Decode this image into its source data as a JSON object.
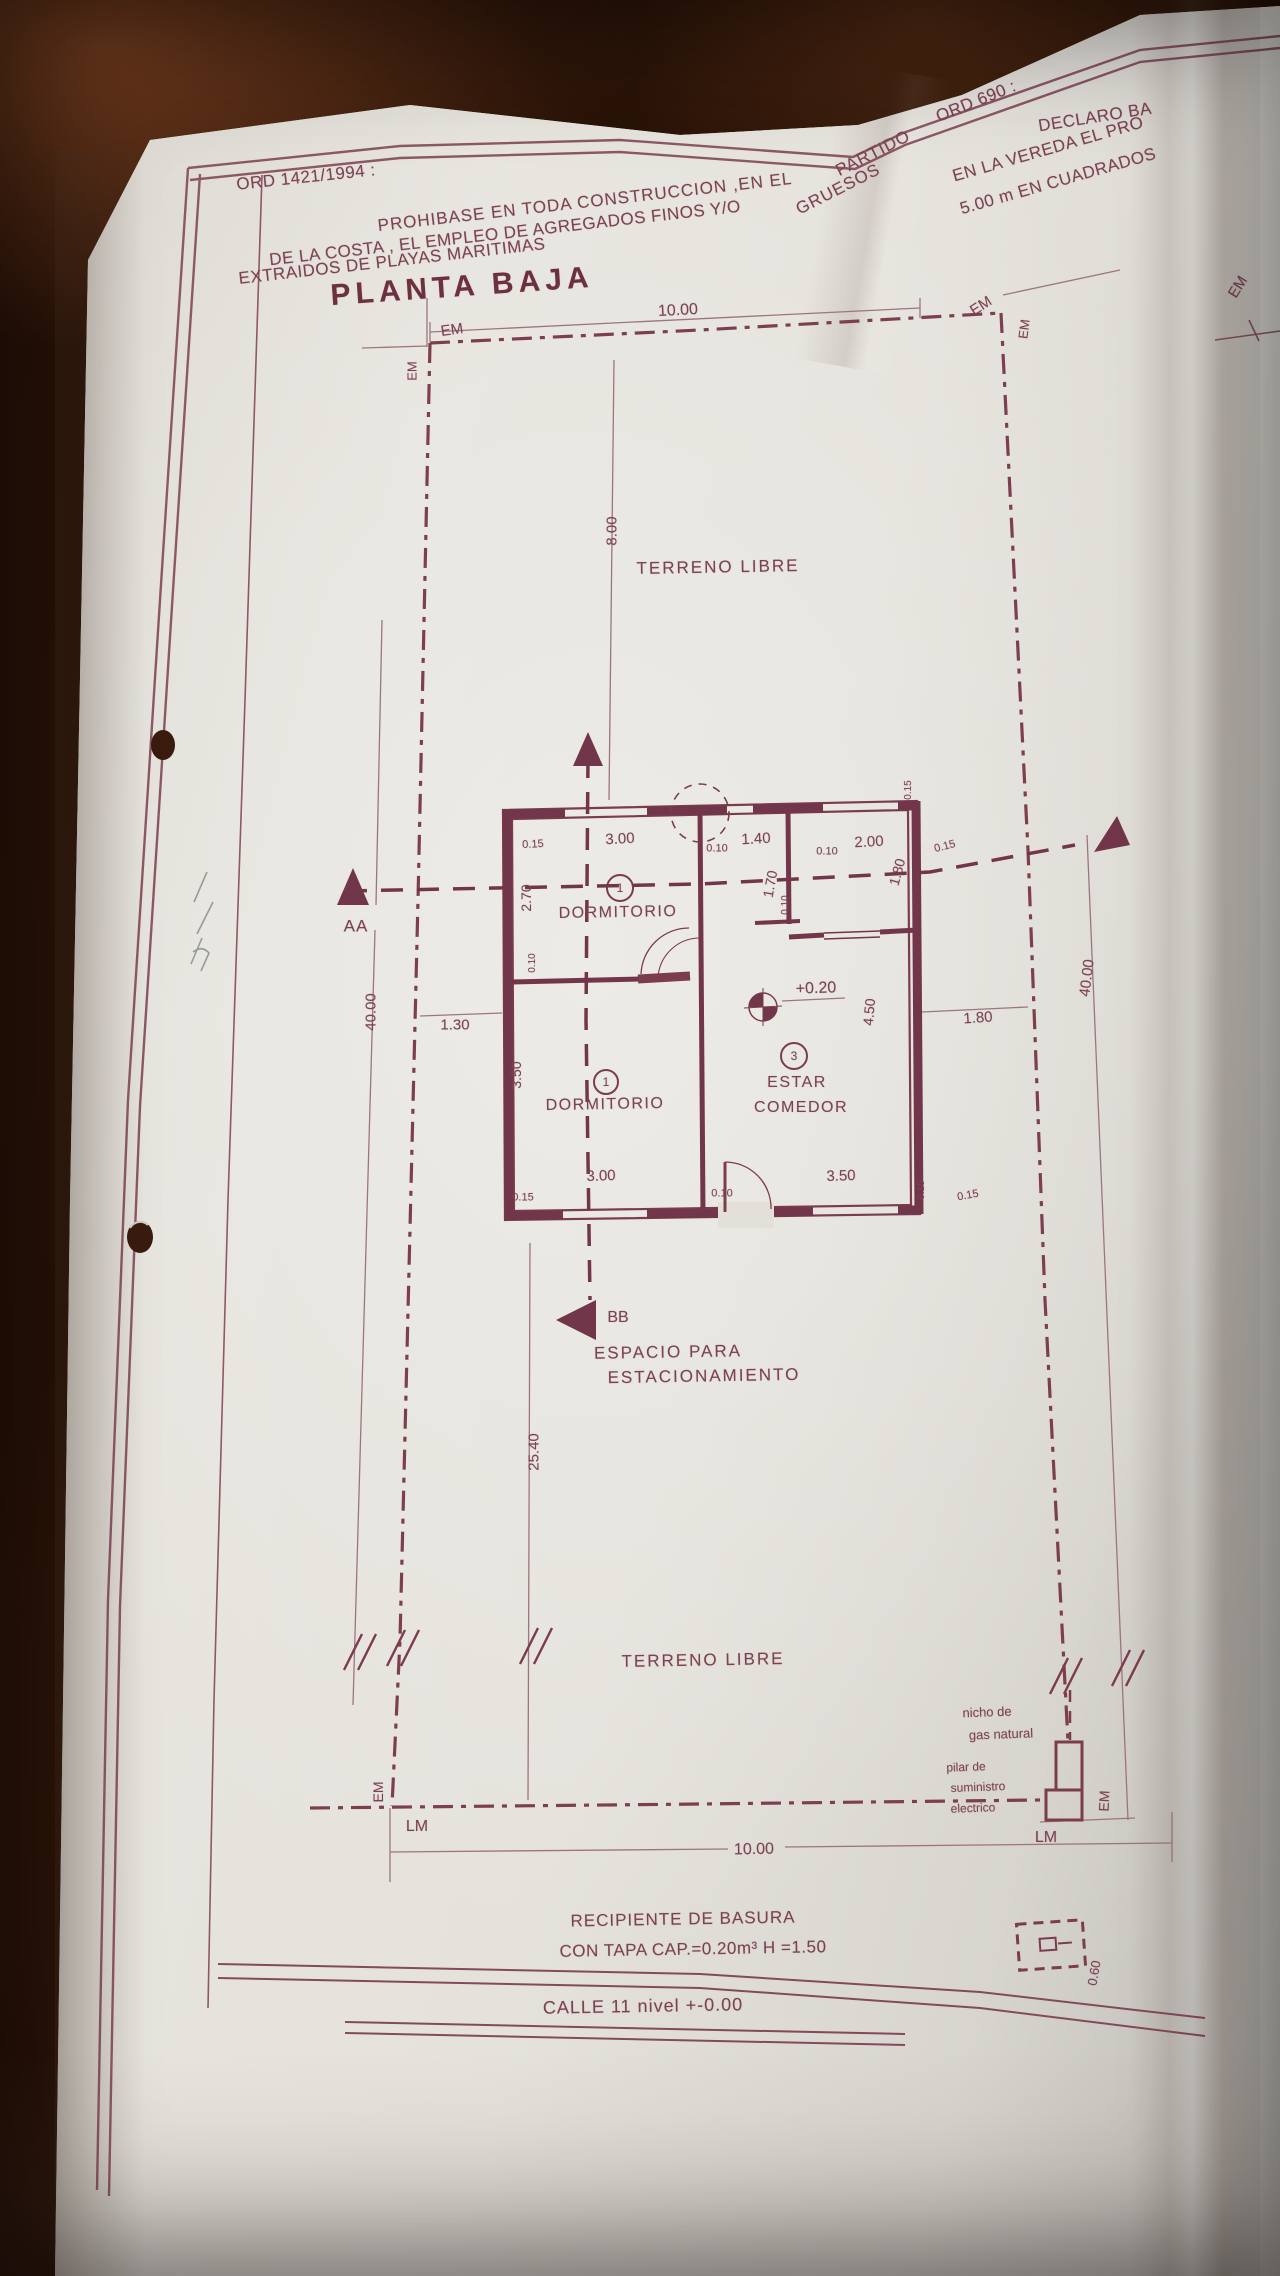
{
  "colors": {
    "ink": "#7c4253",
    "ink_dark": "#6d3040",
    "ink_light": "#9d7580",
    "paper": "#e7e4de",
    "table_wood": "#2c1207"
  },
  "title": "PLANTA BAJA",
  "ordinance_1421": {
    "ref": "ORD 1421/1994 :",
    "text": "PROHIBASE EN TODA CONSTRUCCION ,EN EL PARTIDO DE LA COSTA , EL EMPLEO DE AGREGADOS FINOS Y/O GRUESOS EXTRAIDOS DE PLAYAS MARITIMAS"
  },
  "ordinance_690": {
    "ref": "ORD 690 :",
    "text": "DECLARO BA EN LA VEREDA EL PRO 5.00 m EN CUADRADOS"
  },
  "street": "CALLE 11 nivel +-0.00",
  "labels": [
    {
      "n": "ord-1421-ref",
      "t": "ORD 1421/1994 :",
      "x": 306,
      "y": 177,
      "s": 17,
      "r": -6,
      "ls": 0.5
    },
    {
      "n": "ord-1421-line-1",
      "t": "PROHIBASE EN TODA CONSTRUCCION ,EN EL",
      "x": 585,
      "y": 202,
      "s": 17,
      "r": -6.5,
      "ls": 1
    },
    {
      "n": "ord-1421-partido",
      "t": "PARTIDO",
      "x": 873,
      "y": 153,
      "s": 17,
      "r": -27,
      "ls": 1
    },
    {
      "n": "ord-1421-line-2",
      "t": "DE LA COSTA , EL EMPLEO DE AGREGADOS FINOS Y/O",
      "x": 505,
      "y": 233,
      "s": 17,
      "r": -6.5,
      "ls": 0.5
    },
    {
      "n": "ord-1421-gruesos",
      "t": "GRUESOS",
      "x": 838,
      "y": 189,
      "s": 17,
      "r": -27,
      "ls": 1
    },
    {
      "n": "ord-1421-line-3",
      "t": "EXTRAIDOS DE PLAYAS MARITIMAS",
      "x": 392,
      "y": 261,
      "s": 17,
      "r": -6.5,
      "ls": 0.5
    },
    {
      "n": "ord-690-ref",
      "t": "ORD 690 :",
      "x": 976,
      "y": 101,
      "s": 17,
      "r": -22,
      "ls": 0.5
    },
    {
      "n": "ord-690-line-1",
      "t": "DECLARO BA",
      "x": 1095,
      "y": 117,
      "s": 17,
      "r": -9,
      "ls": 0.5
    },
    {
      "n": "ord-690-line-2",
      "t": "EN LA VEREDA EL PRO",
      "x": 1048,
      "y": 149,
      "s": 17,
      "r": -16,
      "ls": 0.5
    },
    {
      "n": "ord-690-line-3",
      "t": "5.00 m EN CUADRADOS",
      "x": 1058,
      "y": 181,
      "s": 17,
      "r": -16,
      "ls": 0.5
    },
    {
      "n": "plan-title",
      "t": "PLANTA BAJA",
      "x": 462,
      "y": 287,
      "s": 30,
      "r": -4,
      "w": 700,
      "ls": 5,
      "c": "#6d3040"
    },
    {
      "n": "dim-lot-width-top",
      "t": "10.00",
      "x": 678,
      "y": 311,
      "s": 16,
      "r": -3
    },
    {
      "n": "em-label-top-left",
      "t": "EM",
      "x": 452,
      "y": 330,
      "s": 15,
      "r": -8
    },
    {
      "n": "em-label-left",
      "t": "EM",
      "x": 412,
      "y": 371,
      "s": 13,
      "r": -90
    },
    {
      "n": "em-label-top-right",
      "t": "EM",
      "x": 981,
      "y": 306,
      "s": 15,
      "r": -33
    },
    {
      "n": "em-label-right",
      "t": "EM",
      "x": 1024,
      "y": 329,
      "s": 13,
      "r": -83
    },
    {
      "n": "em-label-far-right",
      "t": "EM",
      "x": 1238,
      "y": 287,
      "s": 15,
      "r": -58
    },
    {
      "n": "dim-label",
      "t": "8.00",
      "x": 612,
      "y": 531,
      "s": 15,
      "r": -90
    },
    {
      "n": "terreno-libre-top",
      "t": "TERRENO LIBRE",
      "x": 718,
      "y": 567,
      "s": 17,
      "r": -1,
      "ls": 2
    },
    {
      "n": "section-label-aa",
      "t": "AA",
      "x": 356,
      "y": 926,
      "s": 17,
      "r": 0,
      "ls": 1
    },
    {
      "n": "dim-label",
      "t": "0.15",
      "x": 533,
      "y": 845,
      "s": 11,
      "r": -3
    },
    {
      "n": "dim-label",
      "t": "3.00",
      "x": 620,
      "y": 839,
      "s": 15,
      "r": -3
    },
    {
      "n": "dim-label",
      "t": "0.10",
      "x": 717,
      "y": 849,
      "s": 11,
      "r": 0
    },
    {
      "n": "dim-label",
      "t": "1.40",
      "x": 756,
      "y": 839,
      "s": 15,
      "r": -3
    },
    {
      "n": "dim-label",
      "t": "0.10",
      "x": 827,
      "y": 852,
      "s": 11,
      "r": 0
    },
    {
      "n": "dim-label",
      "t": "2.00",
      "x": 869,
      "y": 842,
      "s": 15,
      "r": -3
    },
    {
      "n": "dim-label",
      "t": "0.15",
      "x": 945,
      "y": 847,
      "s": 11,
      "r": -15
    },
    {
      "n": "dim-label",
      "t": "0.15",
      "x": 909,
      "y": 790,
      "s": 10,
      "r": -90
    },
    {
      "n": "dim-label",
      "t": "2.70",
      "x": 526,
      "y": 898,
      "s": 14,
      "r": -90
    },
    {
      "n": "dim-label",
      "t": "1.70",
      "x": 770,
      "y": 884,
      "s": 14,
      "r": -80
    },
    {
      "n": "dim-label",
      "t": "0.10",
      "x": 786,
      "y": 905,
      "s": 10,
      "r": -90
    },
    {
      "n": "dim-label",
      "t": "1.80",
      "x": 897,
      "y": 872,
      "s": 14,
      "r": -75
    },
    {
      "n": "room-label-dormitorio-1",
      "t": "DORMITORIO",
      "x": 618,
      "y": 913,
      "s": 16,
      "r": -1,
      "ls": 1.5
    },
    {
      "n": "room-number",
      "t": "1",
      "x": 620,
      "y": 888,
      "s": 12
    },
    {
      "n": "dim-label",
      "t": "0.10",
      "x": 533,
      "y": 963,
      "s": 10,
      "r": -90
    },
    {
      "n": "dim-label",
      "t": "1.30",
      "x": 455,
      "y": 1025,
      "s": 15,
      "r": 0
    },
    {
      "n": "dim-label",
      "t": "3.50",
      "x": 516,
      "y": 1075,
      "s": 14,
      "r": -90
    },
    {
      "n": "room-label-dormitorio-2",
      "t": "DORMITORIO",
      "x": 605,
      "y": 1105,
      "s": 16,
      "r": -1,
      "ls": 1.5
    },
    {
      "n": "room-number",
      "t": "1",
      "x": 606,
      "y": 1082,
      "s": 12
    },
    {
      "n": "level-value",
      "t": "+0.20",
      "x": 816,
      "y": 989,
      "s": 16,
      "r": -2
    },
    {
      "n": "dim-label",
      "t": "4.50",
      "x": 869,
      "y": 1012,
      "s": 14,
      "r": -85
    },
    {
      "n": "room-number",
      "t": "3",
      "x": 794,
      "y": 1056,
      "s": 12
    },
    {
      "n": "room-label-estar",
      "t": "ESTAR",
      "x": 797,
      "y": 1083,
      "s": 16,
      "r": 0,
      "ls": 1.5
    },
    {
      "n": "room-label-comedor",
      "t": "COMEDOR",
      "x": 801,
      "y": 1108,
      "s": 16,
      "r": 0,
      "ls": 1.5
    },
    {
      "n": "dim-label",
      "t": "1.80",
      "x": 978,
      "y": 1018,
      "s": 15,
      "r": -4
    },
    {
      "n": "dim-lot-depth-left",
      "t": "40.00",
      "x": 371,
      "y": 1012,
      "s": 15,
      "r": -90
    },
    {
      "n": "dim-lot-depth-right",
      "t": "40.00",
      "x": 1087,
      "y": 978,
      "s": 15,
      "r": -83
    },
    {
      "n": "dim-label",
      "t": "3.00",
      "x": 601,
      "y": 1176,
      "s": 15,
      "r": -2
    },
    {
      "n": "dim-label",
      "t": "0.10",
      "x": 722,
      "y": 1194,
      "s": 11,
      "r": 0
    },
    {
      "n": "dim-label",
      "t": "3.50",
      "x": 841,
      "y": 1176,
      "s": 15,
      "r": -2
    },
    {
      "n": "dim-label",
      "t": "0.15",
      "x": 523,
      "y": 1198,
      "s": 11,
      "r": 0
    },
    {
      "n": "dim-label",
      "t": "0.15",
      "x": 922,
      "y": 1190,
      "s": 10,
      "r": -90
    },
    {
      "n": "dim-label",
      "t": "0.15",
      "x": 968,
      "y": 1196,
      "s": 11,
      "r": -10
    },
    {
      "n": "section-label-bb",
      "t": "BB",
      "x": 618,
      "y": 1318,
      "s": 16,
      "r": 0
    },
    {
      "n": "espacio-line-1",
      "t": "ESPACIO PARA",
      "x": 668,
      "y": 1352,
      "s": 17,
      "r": -1,
      "ls": 2
    },
    {
      "n": "espacio-line-2",
      "t": "ESTACIONAMIENTO",
      "x": 704,
      "y": 1376,
      "s": 17,
      "r": -1,
      "ls": 2
    },
    {
      "n": "dim-label",
      "t": "25.40",
      "x": 534,
      "y": 1452,
      "s": 15,
      "r": -90
    },
    {
      "n": "terreno-libre-bottom",
      "t": "TERRENO LIBRE",
      "x": 703,
      "y": 1660,
      "s": 17,
      "r": -1,
      "ls": 2
    },
    {
      "n": "nicho-gas-line-1",
      "t": "nicho de",
      "x": 987,
      "y": 1712,
      "s": 13,
      "r": -2
    },
    {
      "n": "nicho-gas-line-2",
      "t": "gas natural",
      "x": 1001,
      "y": 1734,
      "s": 13,
      "r": -2
    },
    {
      "n": "pilar-line-1",
      "t": "pilar de",
      "x": 966,
      "y": 1767,
      "s": 12,
      "r": -2
    },
    {
      "n": "pilar-line-2",
      "t": "suministro",
      "x": 978,
      "y": 1787,
      "s": 12,
      "r": -2
    },
    {
      "n": "pilar-line-3",
      "t": "electrico",
      "x": 973,
      "y": 1808,
      "s": 12,
      "r": -2
    },
    {
      "n": "em-label-bottom-right",
      "t": "EM",
      "x": 1104,
      "y": 1801,
      "s": 14,
      "r": -87
    },
    {
      "n": "em-label-bottom-left",
      "t": "EM",
      "x": 378,
      "y": 1792,
      "s": 14,
      "r": -90
    },
    {
      "n": "lm-label-left",
      "t": "LM",
      "x": 417,
      "y": 1827,
      "s": 16,
      "r": 0
    },
    {
      "n": "lm-label-right",
      "t": "LM",
      "x": 1046,
      "y": 1838,
      "s": 16,
      "r": 0
    },
    {
      "n": "dim-lot-width-bottom",
      "t": "10.00",
      "x": 754,
      "y": 1850,
      "s": 16,
      "r": -1
    },
    {
      "n": "basura-line-1",
      "t": "RECIPIENTE DE BASURA",
      "x": 683,
      "y": 1919,
      "s": 17,
      "r": -1,
      "ls": 1
    },
    {
      "n": "basura-line-2",
      "t": "CON TAPA CAP.=0.20m³ H =1.50",
      "x": 693,
      "y": 1949,
      "s": 17,
      "r": -1,
      "ls": 0.5
    },
    {
      "n": "street-label",
      "t": "CALLE 11 nivel +-0.00",
      "x": 643,
      "y": 2006,
      "s": 18,
      "r": -1,
      "ls": 1
    },
    {
      "n": "dim-label",
      "t": "0.60",
      "x": 1094,
      "y": 1973,
      "s": 13,
      "r": -80
    }
  ]
}
